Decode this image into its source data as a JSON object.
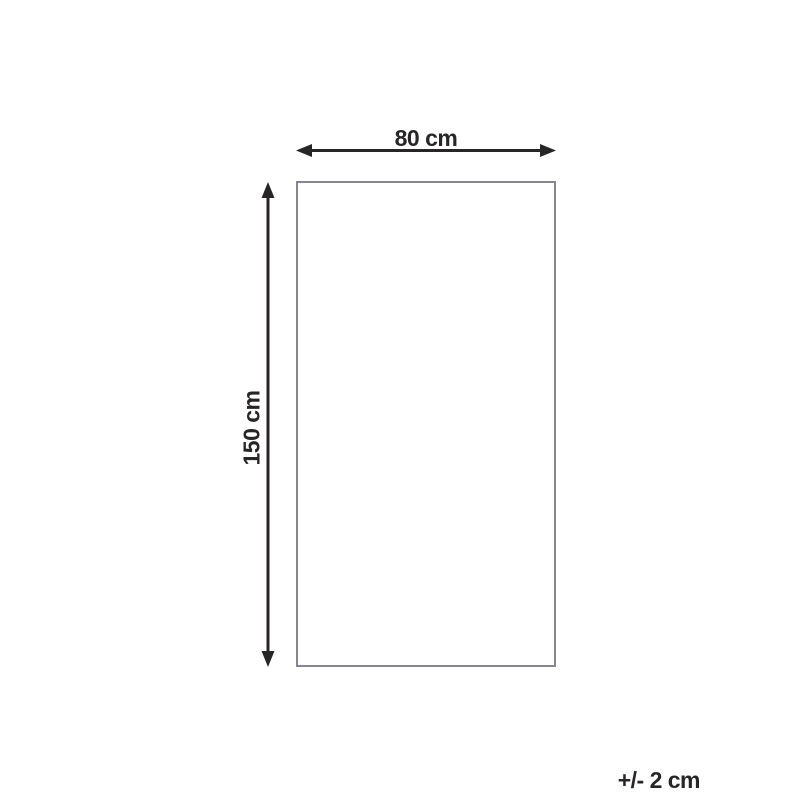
{
  "diagram": {
    "title": "product-dimension-diagram",
    "width_label": "80 cm",
    "height_label": "150 cm",
    "tolerance_label": "+/- 2 cm",
    "shape": "rectangle",
    "width_cm": 80,
    "height_cm": 150,
    "tolerance_cm": 2
  },
  "colors": {
    "arrow": "#282526",
    "text": "#282526",
    "outline": "#85878a",
    "background": "#ffffff"
  }
}
